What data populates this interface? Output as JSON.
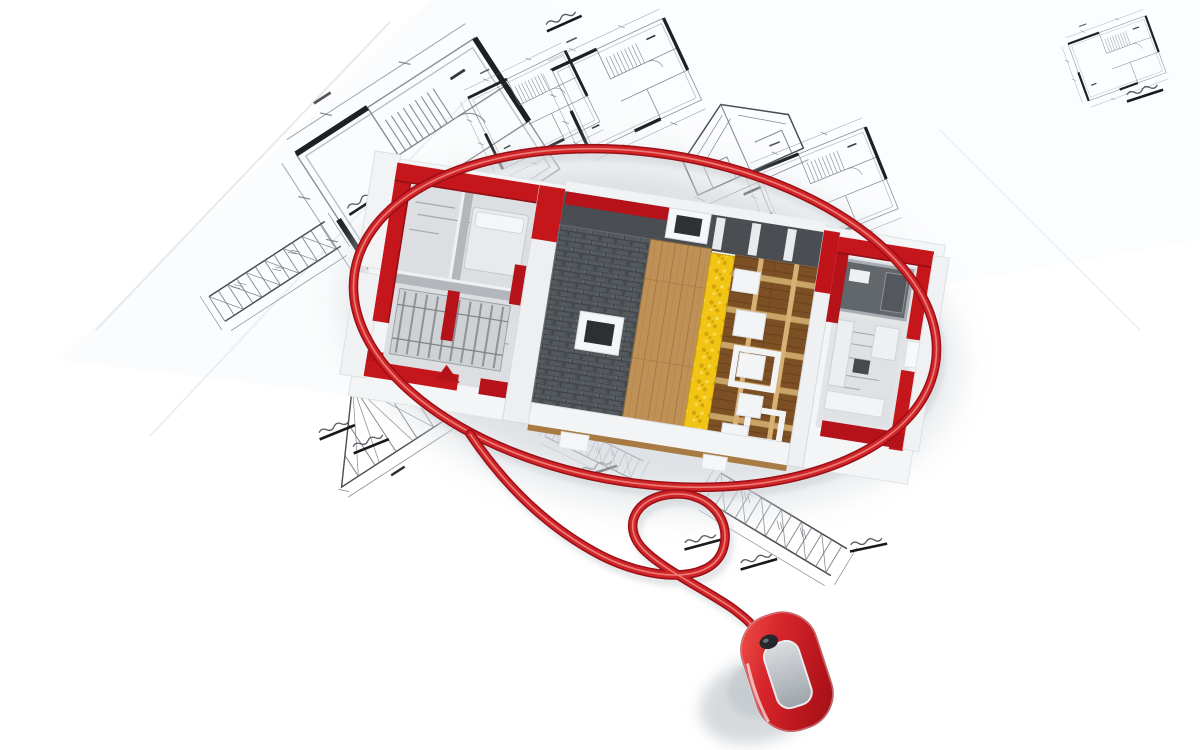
{
  "scene": {
    "type": "3d-render-photo",
    "description": "Miniature model house under construction encircled by the red cable of a computer mouse, resting on scattered architectural blueprints",
    "background_color": "#ffffff",
    "objects": {
      "blueprints": {
        "name": "architectural-blueprints",
        "paper_color": "#ffffff",
        "line_color": "#6e737a",
        "wall_line_color": "#1d2024",
        "drawing_kinds": [
          "floor-plan",
          "roof-truss",
          "triangle-truss",
          "gable-section",
          "dimension-label"
        ]
      },
      "house": {
        "name": "model-house-under-construction",
        "wall_red": "#c4161b",
        "wall_red_dark": "#9d0f14",
        "roof_slate": "#54595d",
        "roof_planks": "#bf9157",
        "floor_wood": "#7c4f24",
        "beam_tan": "#c9a468",
        "insulation_yellow": "#f2c414",
        "interior_floor_gray": "#dcdee1",
        "partition_gray": "#b3b7bb",
        "trim_white": "#f3f4f5",
        "eave_brown": "#a97b44"
      },
      "cable": {
        "name": "mouse-cable",
        "color": "#d2252a",
        "dark": "#9a1016",
        "highlight": "#f0958c"
      },
      "mouse": {
        "name": "computer-mouse",
        "body_red": "#d2252a",
        "panel_gray": "#b9bec4",
        "wheel_dark": "#24272b",
        "rim_white": "#ffffff"
      },
      "shadow": {
        "color": "#d7dce0"
      }
    }
  }
}
